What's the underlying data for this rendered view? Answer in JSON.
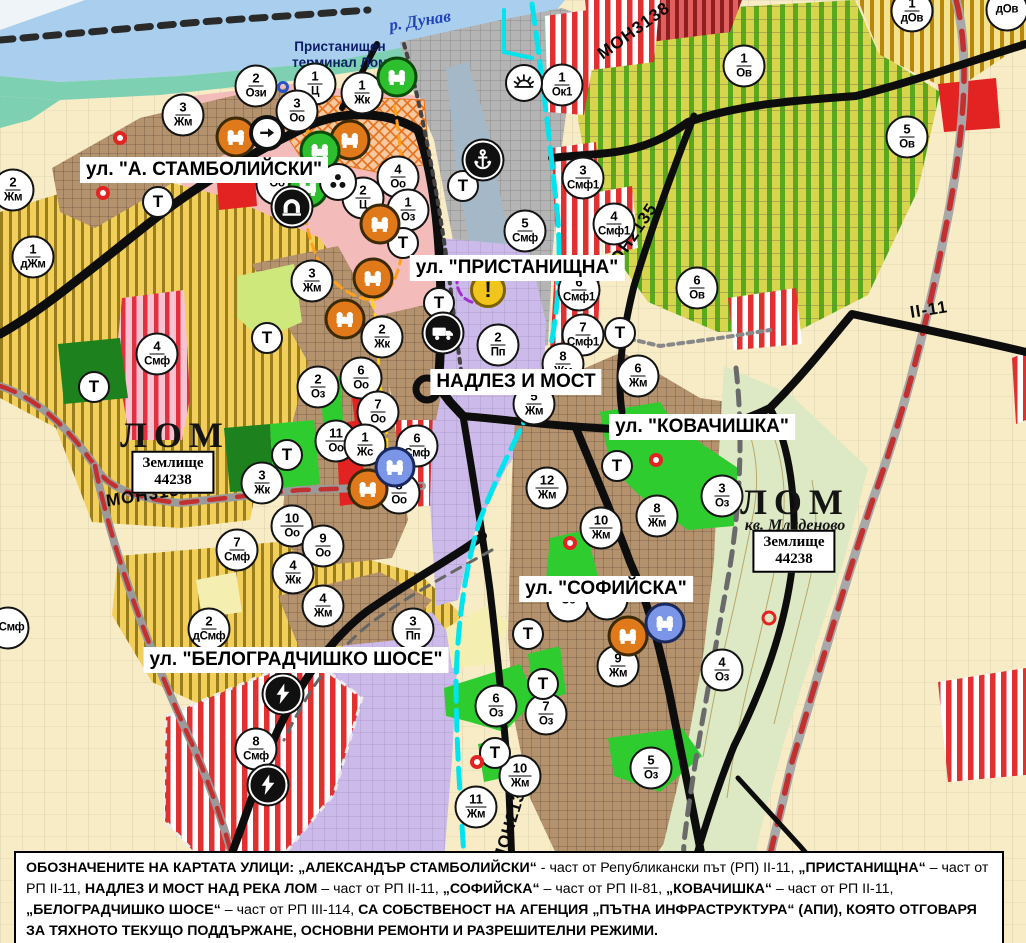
{
  "palette": {
    "river": "#aacfee",
    "shore": "#7ed0b2",
    "port_gray": "#b4b4b4",
    "center_pink": "#f3bcba",
    "zone_yellow": "#f2cf5a",
    "zone_yellow_stripe": "#8a6d10",
    "urban_brown": "#b5926e",
    "zone_purple": "#ccbaeb",
    "vineyard": "#d7d44e",
    "vineyard_stripe": "#5aa81c",
    "cream": "#f7ecc6",
    "green_band": "#dde9c4",
    "smf_red": "#e03030",
    "bright_green": "#2fcc2f",
    "dark_green": "#1d821d",
    "red_accent": "#e32222",
    "orange_icon": "#e0791a",
    "green_icon": "#2dbf2d",
    "blue_icon": "#7b96e6",
    "road_black": "#0d0d0d",
    "rail_red": "#c23030",
    "cyan": "#00e4ee"
  },
  "t_marker_label": "Т",
  "warning_glyph": "!",
  "labels": {
    "river_label": {
      "text": "р. Дунав",
      "x": 420,
      "y": 21
    },
    "terminal_label": {
      "text": "Пристанищен\nтерминал Лом",
      "x": 340,
      "y": 55
    },
    "city_labels": [
      {
        "text": "ЛОМ",
        "x": 175,
        "y": 435
      },
      {
        "text": "ЛОМ",
        "x": 795,
        "y": 502
      }
    ],
    "quarter_label": {
      "text": "кв. Младеново",
      "x": 795,
      "y": 526
    },
    "land_boxes": [
      {
        "text": "Землище\n44238",
        "x": 173,
        "y": 472
      },
      {
        "text": "Землище\n44238",
        "x": 794,
        "y": 551
      }
    ],
    "street_labels": [
      {
        "text": "ул. \"А. СТАМБОЛИЙСКИ\"",
        "x": 204,
        "y": 170
      },
      {
        "text": "ул. \"ПРИСТАНИЩНА\"",
        "x": 517,
        "y": 268
      },
      {
        "text": "НАДЛЕЗ И МОСТ",
        "x": 516,
        "y": 382
      },
      {
        "text": "ул. \"КОВАЧИШКА\"",
        "x": 702,
        "y": 427
      },
      {
        "text": "ул. \"СОФИЙСКА\"",
        "x": 606,
        "y": 589
      },
      {
        "text": "ул. \"БЕЛОГРАДЧИШКО ШОСЕ\"",
        "x": 296,
        "y": 660
      }
    ],
    "road_labels": [
      {
        "text": "МОН3139",
        "x": 148,
        "y": 495,
        "rot": -9
      },
      {
        "text": "МОН3138",
        "x": 634,
        "y": 31,
        "rot": -36
      },
      {
        "text": "МОН2135",
        "x": 630,
        "y": 240,
        "rot": -56
      },
      {
        "text": "МОН2136",
        "x": 511,
        "y": 822,
        "rot": -73
      },
      {
        "text": "II-11",
        "x": 929,
        "y": 310,
        "rot": -9
      }
    ]
  },
  "zone_markers": [
    {
      "n": "2",
      "a": "Ози",
      "x": 256,
      "y": 86
    },
    {
      "n": "1",
      "a": "Ц",
      "x": 315,
      "y": 84
    },
    {
      "n": "3",
      "a": "Оо",
      "x": 297,
      "y": 111
    },
    {
      "n": "1",
      "a": "Жк",
      "x": 362,
      "y": 93
    },
    {
      "n": "3",
      "a": "Жм",
      "x": 183,
      "y": 115
    },
    {
      "n": "2",
      "a": "Жм",
      "x": 13,
      "y": 190
    },
    {
      "n": "1",
      "a": "дЖм",
      "x": 33,
      "y": 257
    },
    {
      "n": "4",
      "a": "Смф",
      "x": 157,
      "y": 354
    },
    {
      "n": "4",
      "a": "Оо",
      "x": 398,
      "y": 177
    },
    {
      "n": "2",
      "a": "Ц",
      "x": 363,
      "y": 198
    },
    {
      "n": "1",
      "a": "Оз",
      "x": 408,
      "y": 210
    },
    {
      "n": "3",
      "a": "Жм",
      "x": 312,
      "y": 281
    },
    {
      "n": "",
      "a": "Оо",
      "x": 277,
      "y": 184
    },
    {
      "n": "1",
      "a": "Ок1",
      "x": 562,
      "y": 85
    },
    {
      "n": "3",
      "a": "Смф1",
      "x": 583,
      "y": 178
    },
    {
      "n": "4",
      "a": "Смф1",
      "x": 614,
      "y": 224
    },
    {
      "n": "5",
      "a": "Смф",
      "x": 525,
      "y": 231
    },
    {
      "n": "6",
      "a": "Смф1",
      "x": 579,
      "y": 290
    },
    {
      "n": "7",
      "a": "Смф1",
      "x": 583,
      "y": 335
    },
    {
      "n": "1",
      "a": "Ов",
      "x": 744,
      "y": 66
    },
    {
      "n": "5",
      "a": "Ов",
      "x": 907,
      "y": 137
    },
    {
      "n": "1",
      "a": "дОв",
      "x": 912,
      "y": 11
    },
    {
      "n": "",
      "a": "дОв",
      "x": 1007,
      "y": 10
    },
    {
      "n": "6",
      "a": "Ов",
      "x": 697,
      "y": 288
    },
    {
      "n": "2",
      "a": "Пп",
      "x": 498,
      "y": 345
    },
    {
      "n": "2",
      "a": "Жк",
      "x": 382,
      "y": 337
    },
    {
      "n": "6",
      "a": "Оо",
      "x": 361,
      "y": 378
    },
    {
      "n": "7",
      "a": "Оо",
      "x": 378,
      "y": 412
    },
    {
      "n": "2",
      "a": "Оз",
      "x": 318,
      "y": 387
    },
    {
      "n": "11",
      "a": "Оо",
      "x": 336,
      "y": 441
    },
    {
      "n": "1",
      "a": "Жс",
      "x": 365,
      "y": 445
    },
    {
      "n": "6",
      "a": "Смф",
      "x": 417,
      "y": 446
    },
    {
      "n": "8",
      "a": "Оо",
      "x": 399,
      "y": 493
    },
    {
      "n": "3",
      "a": "Жк",
      "x": 262,
      "y": 483
    },
    {
      "n": "10",
      "a": "Оо",
      "x": 292,
      "y": 526
    },
    {
      "n": "9",
      "a": "Оо",
      "x": 323,
      "y": 546
    },
    {
      "n": "7",
      "a": "Смф",
      "x": 237,
      "y": 550
    },
    {
      "n": "4",
      "a": "Жк",
      "x": 293,
      "y": 573
    },
    {
      "n": "8",
      "a": "Жм",
      "x": 563,
      "y": 364
    },
    {
      "n": "5",
      "a": "Жм",
      "x": 534,
      "y": 404
    },
    {
      "n": "6",
      "a": "Жм",
      "x": 638,
      "y": 376
    },
    {
      "n": "12",
      "a": "Жм",
      "x": 547,
      "y": 488
    },
    {
      "n": "10",
      "a": "Жм",
      "x": 601,
      "y": 528
    },
    {
      "n": "8",
      "a": "Жм",
      "x": 657,
      "y": 516
    },
    {
      "n": "3",
      "a": "Оз",
      "x": 722,
      "y": 496
    },
    {
      "n": "9",
      "a": "Жм",
      "x": 618,
      "y": 666
    },
    {
      "n": "4",
      "a": "Оз",
      "x": 722,
      "y": 670
    },
    {
      "n": "",
      "a": "Оз",
      "x": 568,
      "y": 601
    },
    {
      "n": "",
      "a": "Оз",
      "x": 607,
      "y": 599
    },
    {
      "n": "6",
      "a": "Оз",
      "x": 496,
      "y": 706
    },
    {
      "n": "7",
      "a": "Оз",
      "x": 546,
      "y": 714
    },
    {
      "n": "10",
      "a": "Жм",
      "x": 520,
      "y": 776
    },
    {
      "n": "11",
      "a": "Жм",
      "x": 476,
      "y": 807
    },
    {
      "n": "5",
      "a": "Оз",
      "x": 651,
      "y": 768
    },
    {
      "n": "4",
      "a": "Жм",
      "x": 323,
      "y": 606
    },
    {
      "n": "2",
      "a": "дСмф",
      "x": 209,
      "y": 629
    },
    {
      "n": "3",
      "a": "Пп",
      "x": 413,
      "y": 629
    },
    {
      "n": "8",
      "a": "Смф",
      "x": 256,
      "y": 749
    },
    {
      "n": "",
      "a": "дСмф",
      "x": 8,
      "y": 628
    }
  ],
  "t_markers": [
    {
      "x": 94,
      "y": 387
    },
    {
      "x": 158,
      "y": 202
    },
    {
      "x": 267,
      "y": 338
    },
    {
      "x": 287,
      "y": 455
    },
    {
      "x": 403,
      "y": 243
    },
    {
      "x": 439,
      "y": 303
    },
    {
      "x": 463,
      "y": 186
    },
    {
      "x": 528,
      "y": 634
    },
    {
      "x": 543,
      "y": 684
    },
    {
      "x": 495,
      "y": 753
    },
    {
      "x": 617,
      "y": 466
    },
    {
      "x": 620,
      "y": 333
    }
  ],
  "icon_markers": [
    {
      "type": "factory",
      "color": "orange",
      "x": 236,
      "y": 137
    },
    {
      "type": "factory",
      "color": "orange",
      "x": 350,
      "y": 140
    },
    {
      "type": "factory",
      "color": "orange",
      "x": 380,
      "y": 224
    },
    {
      "type": "factory",
      "color": "orange",
      "x": 373,
      "y": 278
    },
    {
      "type": "factory",
      "color": "orange",
      "x": 345,
      "y": 319
    },
    {
      "type": "factory",
      "color": "orange",
      "x": 368,
      "y": 489
    },
    {
      "type": "factory",
      "color": "orange",
      "x": 628,
      "y": 636
    },
    {
      "type": "factory",
      "color": "green",
      "x": 397,
      "y": 77
    },
    {
      "type": "factory",
      "color": "green",
      "x": 320,
      "y": 151
    },
    {
      "type": "factory",
      "color": "green",
      "x": 308,
      "y": 188
    },
    {
      "type": "factory",
      "color": "blue",
      "x": 395,
      "y": 467
    },
    {
      "type": "factory",
      "color": "blue",
      "x": 665,
      "y": 623
    },
    {
      "type": "anchor",
      "x": 483,
      "y": 160
    },
    {
      "type": "sun",
      "x": 524,
      "y": 83
    },
    {
      "type": "truck",
      "x": 443,
      "y": 333
    },
    {
      "type": "lightning",
      "x": 283,
      "y": 694
    },
    {
      "type": "lightning",
      "x": 268,
      "y": 785
    },
    {
      "type": "arrow",
      "x": 267,
      "y": 133
    },
    {
      "type": "tunnel",
      "x": 292,
      "y": 207
    },
    {
      "type": "trefoil",
      "x": 338,
      "y": 182
    },
    {
      "type": "warning",
      "x": 488,
      "y": 290
    },
    {
      "type": "red-dot",
      "x": 120,
      "y": 138
    },
    {
      "type": "red-dot",
      "x": 103,
      "y": 193
    },
    {
      "type": "red-dot",
      "x": 656,
      "y": 460
    },
    {
      "type": "red-dot",
      "x": 570,
      "y": 543
    },
    {
      "type": "red-dot",
      "x": 477,
      "y": 762
    },
    {
      "type": "red-ring",
      "x": 769,
      "y": 618
    },
    {
      "type": "blue-ring",
      "x": 283,
      "y": 87
    }
  ],
  "footer": {
    "segments": [
      {
        "t": "ОБОЗНАЧЕНИТЕ НА КАРТАТА УЛИЦИ: ",
        "b": true
      },
      {
        "t": "„АЛЕКСАНДЪР СТАМБОЛИЙСКИ“",
        "b": true
      },
      {
        "t": " - част от Републикански път (РП) II-11, ",
        "b": false
      },
      {
        "t": "„ПРИСТАНИЩНА“",
        "b": true
      },
      {
        "t": " – част от РП II-11, ",
        "b": false
      },
      {
        "t": "НАДЛЕЗ И МОСТ НАД РЕКА ЛОМ",
        "b": true
      },
      {
        "t": " – част от РП II-11, ",
        "b": false
      },
      {
        "t": "„СОФИЙСКА“",
        "b": true
      },
      {
        "t": " – част от РП II-81, ",
        "b": false
      },
      {
        "t": "„КОВАЧИШКА“",
        "b": true
      },
      {
        "t": " – част от РП II-11, ",
        "b": false
      },
      {
        "t": "„БЕЛОГРАДЧИШКО ШОСЕ“",
        "b": true
      },
      {
        "t": " – част от РП III-114, ",
        "b": false
      },
      {
        "t": "СА СОБСТВЕНОСТ НА АГЕНЦИЯ „ПЪТНА ИНФРАСТРУКТУРА“ (АПИ), КОЯТО ОТГОВАРЯ ЗА ТЯХНОТО ТЕКУЩО ПОДДЪРЖАНЕ, ОСНОВНИ РЕМОНТИ И РАЗРЕШИТЕЛНИ РЕЖИМИ.",
        "b": true
      }
    ]
  }
}
